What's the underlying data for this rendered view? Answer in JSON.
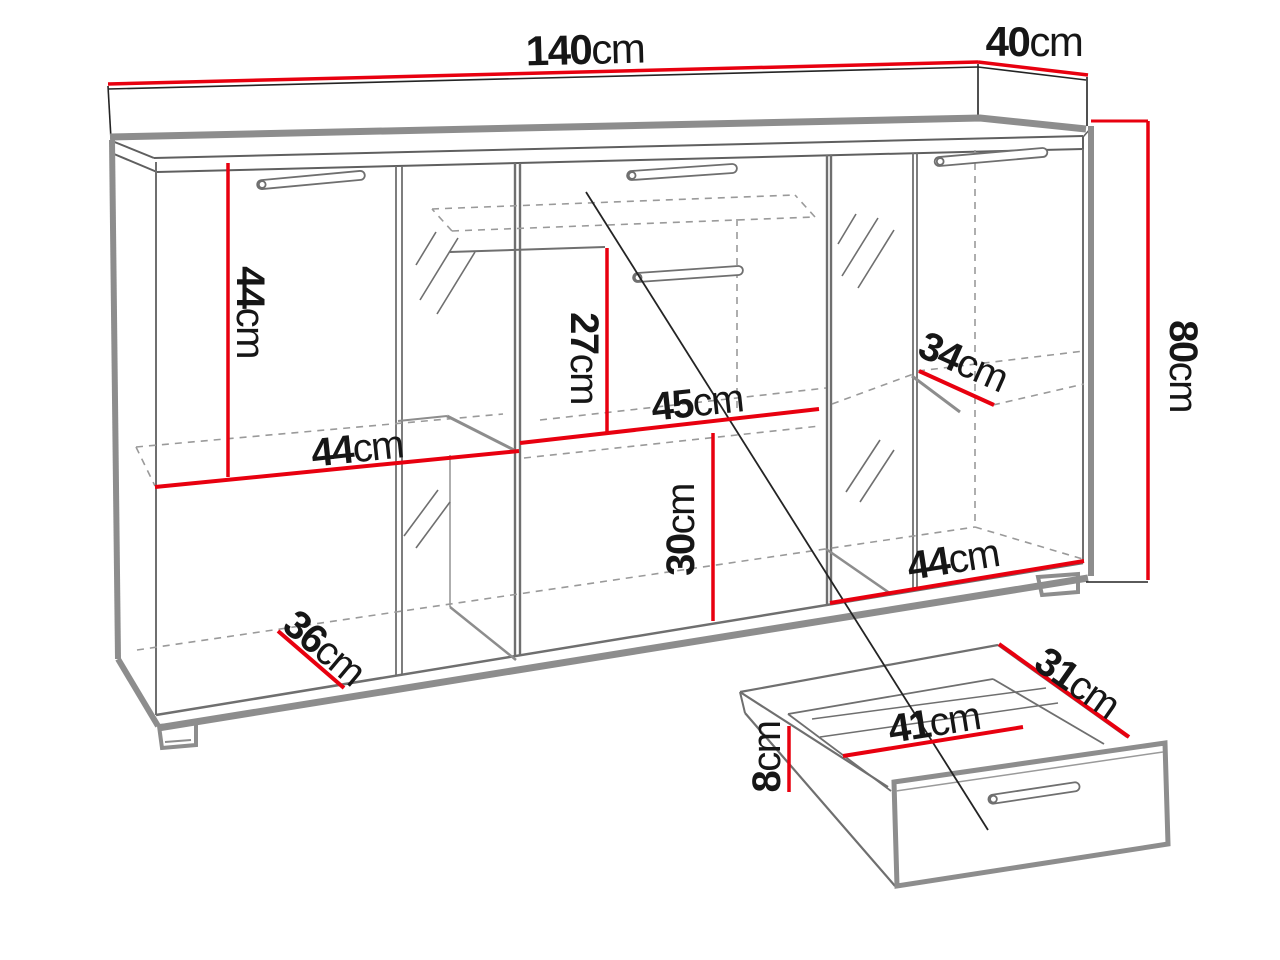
{
  "diagram": {
    "type": "furniture-dimension-diagram",
    "subject": "sideboard cabinet front view with pulled-out drawer detail",
    "unit": "cm"
  },
  "colors": {
    "dimension_line": "#e8000f",
    "outline_thick": "#8d8d8d",
    "outline_thin": "#6f6f6f",
    "dashed": "#9a9a9a",
    "ink": "#161616",
    "background": "#ffffff"
  },
  "dimensions": {
    "width": {
      "num": "140",
      "unit": "cm"
    },
    "depth": {
      "num": "40",
      "unit": "cm"
    },
    "height": {
      "num": "80",
      "unit": "cm"
    },
    "left_compartment_height": {
      "num": "44",
      "unit": "cm"
    },
    "left_compartment_width": {
      "num": "44",
      "unit": "cm"
    },
    "center_top_height": {
      "num": "27",
      "unit": "cm"
    },
    "center_shelf_width": {
      "num": "45",
      "unit": "cm"
    },
    "center_bottom_height": {
      "num": "30",
      "unit": "cm"
    },
    "right_shelf_depth": {
      "num": "34",
      "unit": "cm"
    },
    "right_compartment_width": {
      "num": "44",
      "unit": "cm"
    },
    "base_shelf_depth": {
      "num": "36",
      "unit": "cm"
    },
    "drawer_depth": {
      "num": "31",
      "unit": "cm"
    },
    "drawer_width": {
      "num": "41",
      "unit": "cm"
    },
    "drawer_height": {
      "num": "8",
      "unit": "cm"
    }
  }
}
